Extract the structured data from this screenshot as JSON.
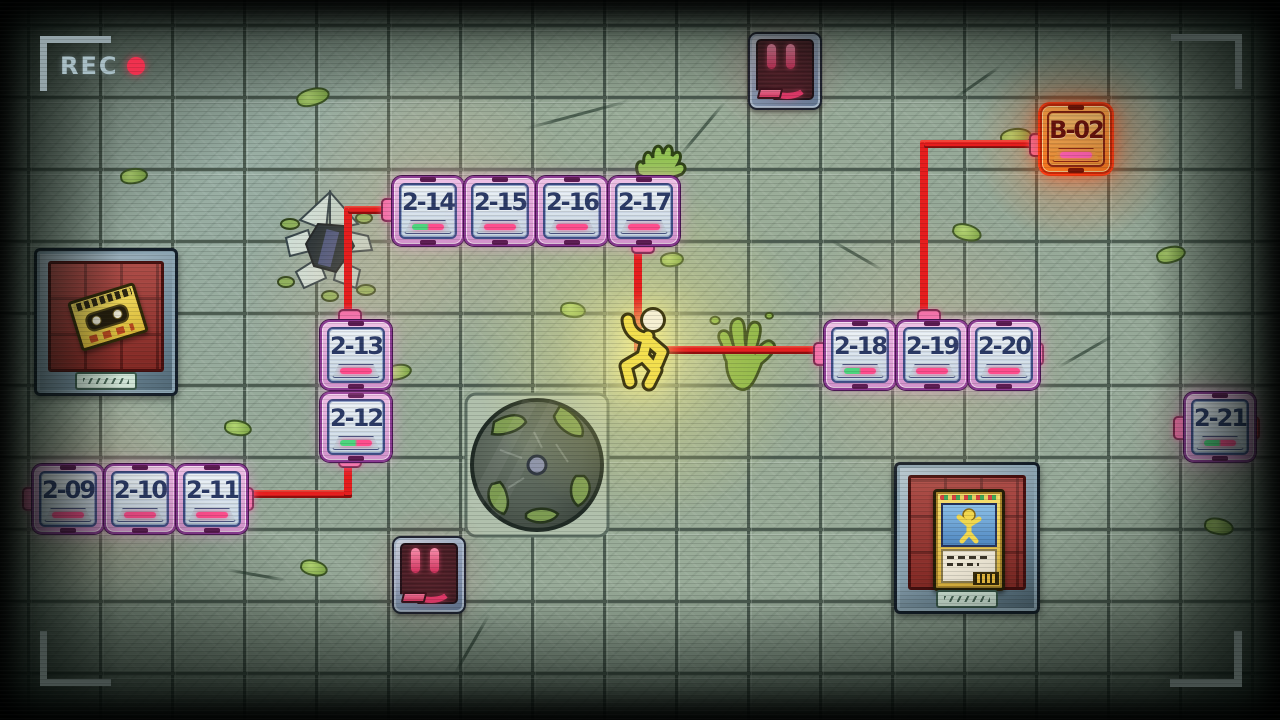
{
  "hud": {
    "rec_label": "REC"
  },
  "map": {
    "tile_size": 72,
    "origin": {
      "x": 30,
      "y": 30
    },
    "levels": [
      {
        "label": "2-09",
        "col": 0,
        "row": 6,
        "type": "normal",
        "slot": "pink"
      },
      {
        "label": "2-10",
        "col": 1,
        "row": 6,
        "type": "normal",
        "slot": "pink"
      },
      {
        "label": "2-11",
        "col": 2,
        "row": 6,
        "type": "normal",
        "slot": "pink"
      },
      {
        "label": "2-12",
        "col": 4,
        "row": 5,
        "type": "normal",
        "slot": "green-pink"
      },
      {
        "label": "2-13",
        "col": 4,
        "row": 4,
        "type": "normal",
        "slot": "pink"
      },
      {
        "label": "2-14",
        "col": 5,
        "row": 2,
        "type": "normal",
        "slot": "green-pink"
      },
      {
        "label": "2-15",
        "col": 6,
        "row": 2,
        "type": "normal",
        "slot": "pink"
      },
      {
        "label": "2-16",
        "col": 7,
        "row": 2,
        "type": "normal",
        "slot": "pink"
      },
      {
        "label": "2-17",
        "col": 8,
        "row": 2,
        "type": "normal",
        "slot": "pink"
      },
      {
        "label": "2-18",
        "col": 11,
        "row": 4,
        "type": "normal",
        "slot": "green-pink"
      },
      {
        "label": "2-19",
        "col": 12,
        "row": 4,
        "type": "normal",
        "slot": "pink"
      },
      {
        "label": "2-20",
        "col": 13,
        "row": 4,
        "type": "normal",
        "slot": "pink"
      },
      {
        "label": "2-21",
        "col": 16,
        "row": 5,
        "type": "normal",
        "slot": "green-pink"
      },
      {
        "label": "B-02",
        "col": 14,
        "row": 1,
        "type": "bonus",
        "slot": "pink"
      }
    ],
    "player": {
      "col": 8,
      "row": 4
    },
    "path_segments": [
      {
        "x": 240,
        "y": 490,
        "w": 112,
        "h": 8
      },
      {
        "x": 344,
        "y": 455,
        "w": 8,
        "h": 42
      },
      {
        "x": 344,
        "y": 206,
        "w": 8,
        "h": 110
      },
      {
        "x": 348,
        "y": 206,
        "w": 46,
        "h": 8
      },
      {
        "x": 634,
        "y": 246,
        "w": 8,
        "h": 106
      },
      {
        "x": 656,
        "y": 346,
        "w": 168,
        "h": 8
      },
      {
        "x": 920,
        "y": 140,
        "w": 8,
        "h": 176
      },
      {
        "x": 924,
        "y": 140,
        "w": 112,
        "h": 8
      }
    ],
    "connectors": [
      {
        "x": 22,
        "y": 487,
        "w": 13,
        "h": 20
      },
      {
        "x": 237,
        "y": 487,
        "w": 13,
        "h": 20
      },
      {
        "x": 338,
        "y": 451,
        "w": 20,
        "h": 13
      },
      {
        "x": 338,
        "y": 381,
        "w": 20,
        "h": 13
      },
      {
        "x": 338,
        "y": 309,
        "w": 20,
        "h": 13
      },
      {
        "x": 381,
        "y": 198,
        "w": 13,
        "h": 20
      },
      {
        "x": 453,
        "y": 198,
        "w": 13,
        "h": 20
      },
      {
        "x": 525,
        "y": 198,
        "w": 13,
        "h": 20
      },
      {
        "x": 597,
        "y": 198,
        "w": 13,
        "h": 20
      },
      {
        "x": 631,
        "y": 237,
        "w": 20,
        "h": 13
      },
      {
        "x": 813,
        "y": 342,
        "w": 13,
        "h": 20
      },
      {
        "x": 885,
        "y": 342,
        "w": 13,
        "h": 20
      },
      {
        "x": 957,
        "y": 342,
        "w": 13,
        "h": 20
      },
      {
        "x": 1027,
        "y": 342,
        "w": 13,
        "h": 20
      },
      {
        "x": 917,
        "y": 309,
        "w": 20,
        "h": 13
      },
      {
        "x": 1029,
        "y": 133,
        "w": 13,
        "h": 20
      },
      {
        "x": 1173,
        "y": 416,
        "w": 11,
        "h": 20
      },
      {
        "x": 1243,
        "y": 416,
        "w": 13,
        "h": 20,
        "variant": "red"
      }
    ]
  },
  "decor": {
    "moss": [
      {
        "x": 296,
        "y": 88,
        "w": 30,
        "h": 14,
        "rot": -15
      },
      {
        "x": 788,
        "y": 84,
        "w": 26,
        "h": 13,
        "rot": 10
      },
      {
        "x": 1000,
        "y": 128,
        "w": 28,
        "h": 14,
        "rot": -8
      },
      {
        "x": 952,
        "y": 224,
        "w": 26,
        "h": 13,
        "rot": 14
      },
      {
        "x": 384,
        "y": 364,
        "w": 24,
        "h": 12,
        "rot": -12
      },
      {
        "x": 224,
        "y": 420,
        "w": 24,
        "h": 12,
        "rot": 8
      },
      {
        "x": 1156,
        "y": 246,
        "w": 26,
        "h": 13,
        "rot": -14
      },
      {
        "x": 1204,
        "y": 518,
        "w": 26,
        "h": 13,
        "rot": 10
      },
      {
        "x": 560,
        "y": 302,
        "w": 22,
        "h": 12,
        "rot": 6
      },
      {
        "x": 120,
        "y": 168,
        "w": 24,
        "h": 12,
        "rot": -8
      },
      {
        "x": 300,
        "y": 560,
        "w": 24,
        "h": 12,
        "rot": 12
      },
      {
        "x": 660,
        "y": 252,
        "w": 20,
        "h": 11,
        "rot": -6
      }
    ],
    "cracks": [
      {
        "x": 575,
        "y": 60,
        "len": 110,
        "rot": 75
      },
      {
        "x": 700,
        "y": 95,
        "len": 70,
        "rot": 40
      },
      {
        "x": 855,
        "y": 225,
        "len": 60,
        "rot": 120
      },
      {
        "x": 1085,
        "y": 318,
        "len": 66,
        "rot": 60
      },
      {
        "x": 470,
        "y": 610,
        "len": 70,
        "rot": 30
      },
      {
        "x": 255,
        "y": 545,
        "len": 60,
        "rot": 100
      },
      {
        "x": 975,
        "y": 55,
        "len": 56,
        "rot": 55
      }
    ],
    "glows": [
      {
        "x": 642,
        "y": 352,
        "r": 170,
        "c": "rgba(238,228,120,.5)"
      },
      {
        "x": 642,
        "y": 352,
        "r": 85,
        "c": "rgba(248,244,160,.45)"
      },
      {
        "x": 430,
        "y": 214,
        "r": 150,
        "c": "rgba(235,195,150,.32)"
      },
      {
        "x": 352,
        "y": 300,
        "r": 110,
        "c": "rgba(235,195,150,.22)"
      },
      {
        "x": 100,
        "y": 498,
        "r": 120,
        "c": "rgba(235,185,150,.3)"
      },
      {
        "x": 930,
        "y": 355,
        "r": 150,
        "c": "rgba(235,195,150,.3)"
      },
      {
        "x": 1076,
        "y": 145,
        "r": 100,
        "c": "rgba(255,110,40,.42)"
      },
      {
        "x": 1216,
        "y": 430,
        "r": 85,
        "c": "rgba(240,160,180,.28)"
      },
      {
        "x": 780,
        "y": 68,
        "r": 70,
        "c": "rgba(200,60,80,.2)"
      },
      {
        "x": 428,
        "y": 574,
        "r": 70,
        "c": "rgba(200,60,80,.18)"
      }
    ]
  },
  "colors": {
    "path_red": "#e61d1d",
    "node_pink_frame": "#e3a8da",
    "node_face_blue": "#dde8ef",
    "node_label_navy": "#2b3a66",
    "bonus_orange": "#f58022",
    "slot_pink": "#ff4d8d",
    "slot_green": "#4ed57e",
    "player_yellow": "#f4e04e",
    "splat_green": "#86b445",
    "rec_red": "#f0304e",
    "tile_green": "#96a998"
  }
}
